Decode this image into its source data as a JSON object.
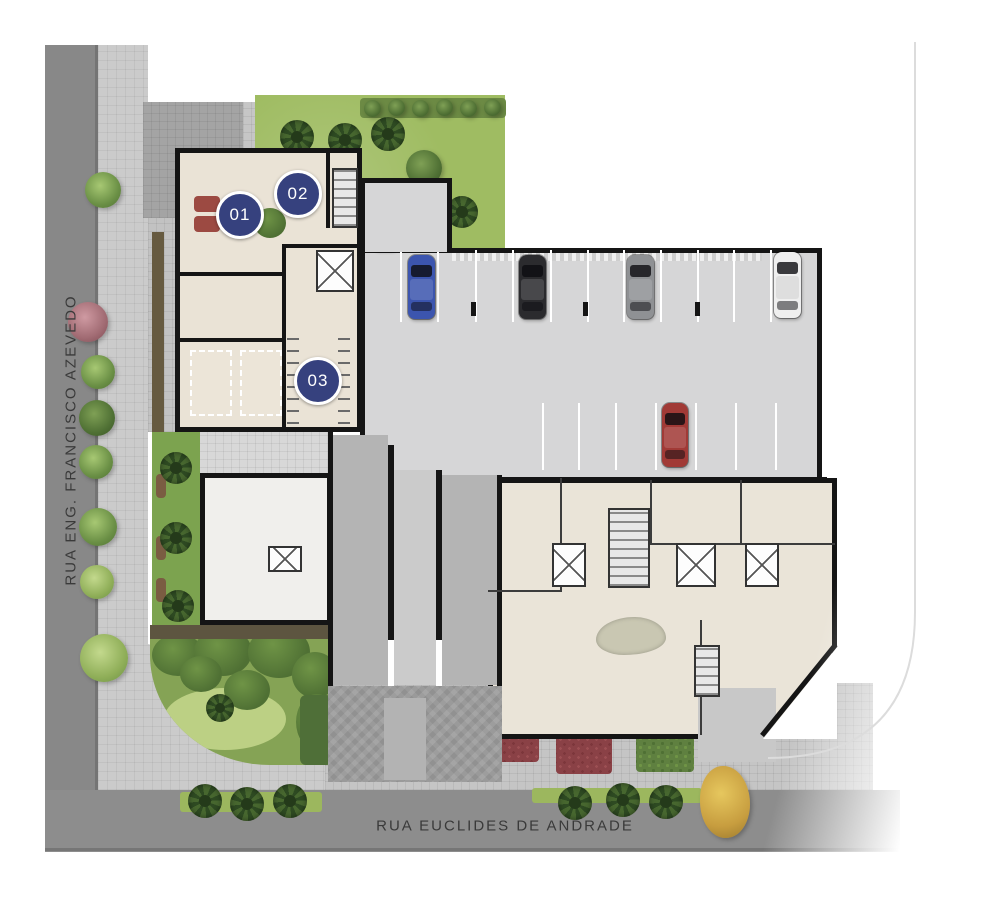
{
  "plan": {
    "street_left": "RUA ENG. FRANCISCO AZEVEDO",
    "street_bottom": "RUA EUCLIDES DE ANDRADE",
    "badges": [
      {
        "label": "01"
      },
      {
        "label": "02"
      },
      {
        "label": "03"
      }
    ],
    "cars": [
      {
        "color": "brown",
        "hex": "#6f5844"
      },
      {
        "color": "blue",
        "hex": "#3c55ae"
      },
      {
        "color": "black",
        "hex": "#2b2b2e"
      },
      {
        "color": "gray",
        "hex": "#8f9194"
      },
      {
        "color": "white",
        "hex": "#efefef"
      },
      {
        "color": "red",
        "hex": "#a13a36"
      }
    ],
    "palette": {
      "badge_blue": "#36417e",
      "wall_black": "#151515",
      "street_gray": "#8a8a8a",
      "sidewalk_gray": "#cbcbcb",
      "lawn_green": "#9fbc62",
      "floor_beige": "#eae3d6",
      "garage_gray": "#d6d6d7"
    }
  }
}
